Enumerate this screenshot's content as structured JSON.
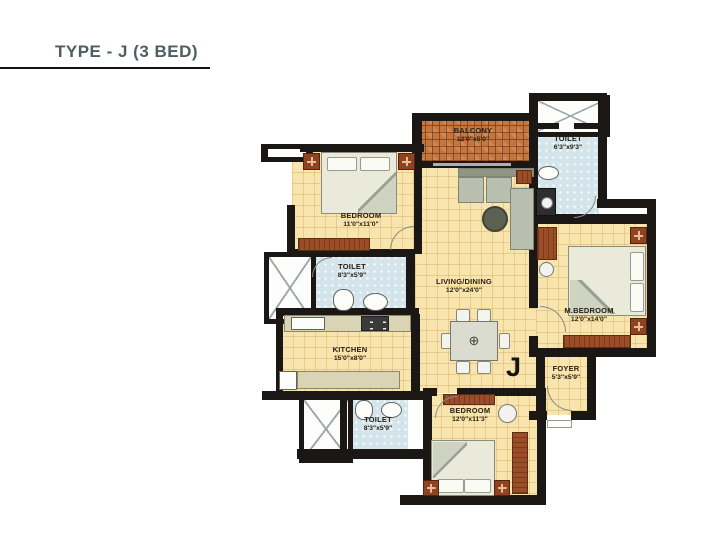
{
  "header": {
    "title": "TYPE - J (3 BED)"
  },
  "plan": {
    "unit_marker": "J",
    "rooms": {
      "bedroom1": {
        "label": "BEDROOM",
        "dims": "11'0\"x11'0\""
      },
      "balcony": {
        "label": "BALCONY",
        "dims": "12'0\"x5'0\""
      },
      "toilet_top": {
        "label": "TOILET",
        "dims": "6'3\"x9'3\""
      },
      "living": {
        "label": "LIVING/DINING",
        "dims": "12'0\"x24'0\""
      },
      "mbedroom": {
        "label": "M.BEDROOM",
        "dims": "12'0\"x14'0\""
      },
      "toilet_mid": {
        "label": "TOILET",
        "dims": "8'3\"x5'9\""
      },
      "kitchen": {
        "label": "KITCHEN",
        "dims": "15'0\"x8'0\""
      },
      "foyer": {
        "label": "FOYER",
        "dims": "5'3\"x5'9\""
      },
      "bedroom2": {
        "label": "BEDROOM",
        "dims": "12'0\"x11'3\""
      },
      "toilet_bottom": {
        "label": "TOILET",
        "dims": "8'3\"x5'9\""
      }
    },
    "colors": {
      "wall": "#1a1714",
      "floor": "#f8e5ae",
      "toilet_tile": "#d3e5eb",
      "balcony_tile": "#c4763e",
      "counter": "#d8d4b4",
      "wood": "#9a4d27",
      "title_text": "#4d5e60"
    }
  }
}
